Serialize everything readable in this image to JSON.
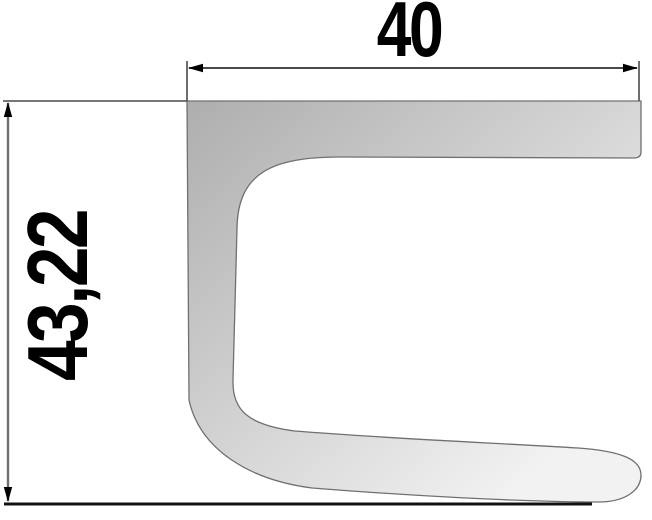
{
  "drawing": {
    "type": "profile-cross-section",
    "width_dimension": {
      "label": "40"
    },
    "height_dimension": {
      "label": "43,22"
    },
    "colors": {
      "background": "#ffffff",
      "profile_dark": "#aeaeae",
      "profile_mid": "#d6d6d6",
      "profile_light": "#f2f2f2",
      "outline": "#707070",
      "dimension_line": "#4a4a4a",
      "thin_dimension_line": "#6e6e6e",
      "baseline": "#111111",
      "arrow": "#000000"
    }
  }
}
